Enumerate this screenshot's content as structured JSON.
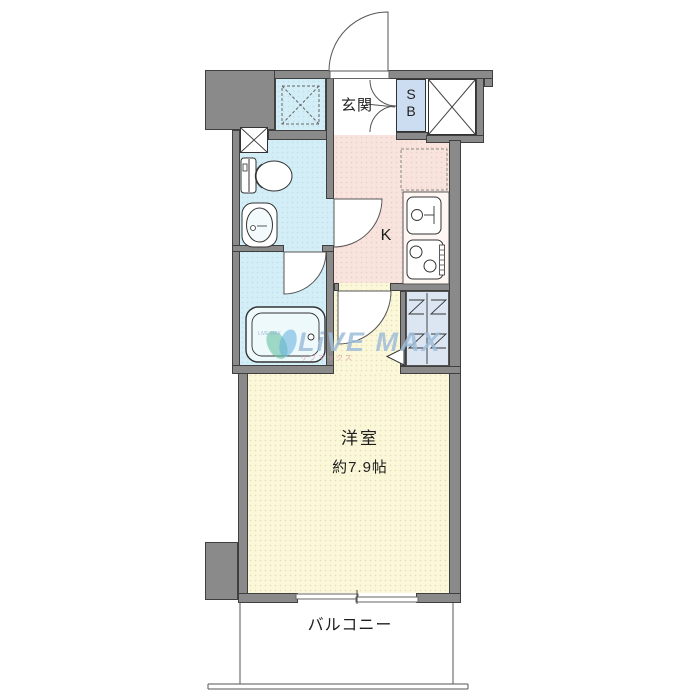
{
  "labels": {
    "genkan": "玄関",
    "shoe_box_top": "S",
    "shoe_box_bottom": "B",
    "kitchen": "K",
    "room_name": "洋室",
    "room_size": "約7.9帖",
    "balcony": "バルコニー"
  },
  "watermark": {
    "brand": "LiVE MAX",
    "brand_micro": "LiVE MAX",
    "brand_kana": "リブマックス"
  },
  "colors": {
    "wall": "#8a8a8a",
    "wet_area": "#d3eef6",
    "kitchen": "#f8e3dd",
    "living_room": "#fbf7d9",
    "closet": "#dce6f3",
    "shoe_box_fill": "#cdddf1",
    "watermark_blue": "#9ebcd8"
  }
}
